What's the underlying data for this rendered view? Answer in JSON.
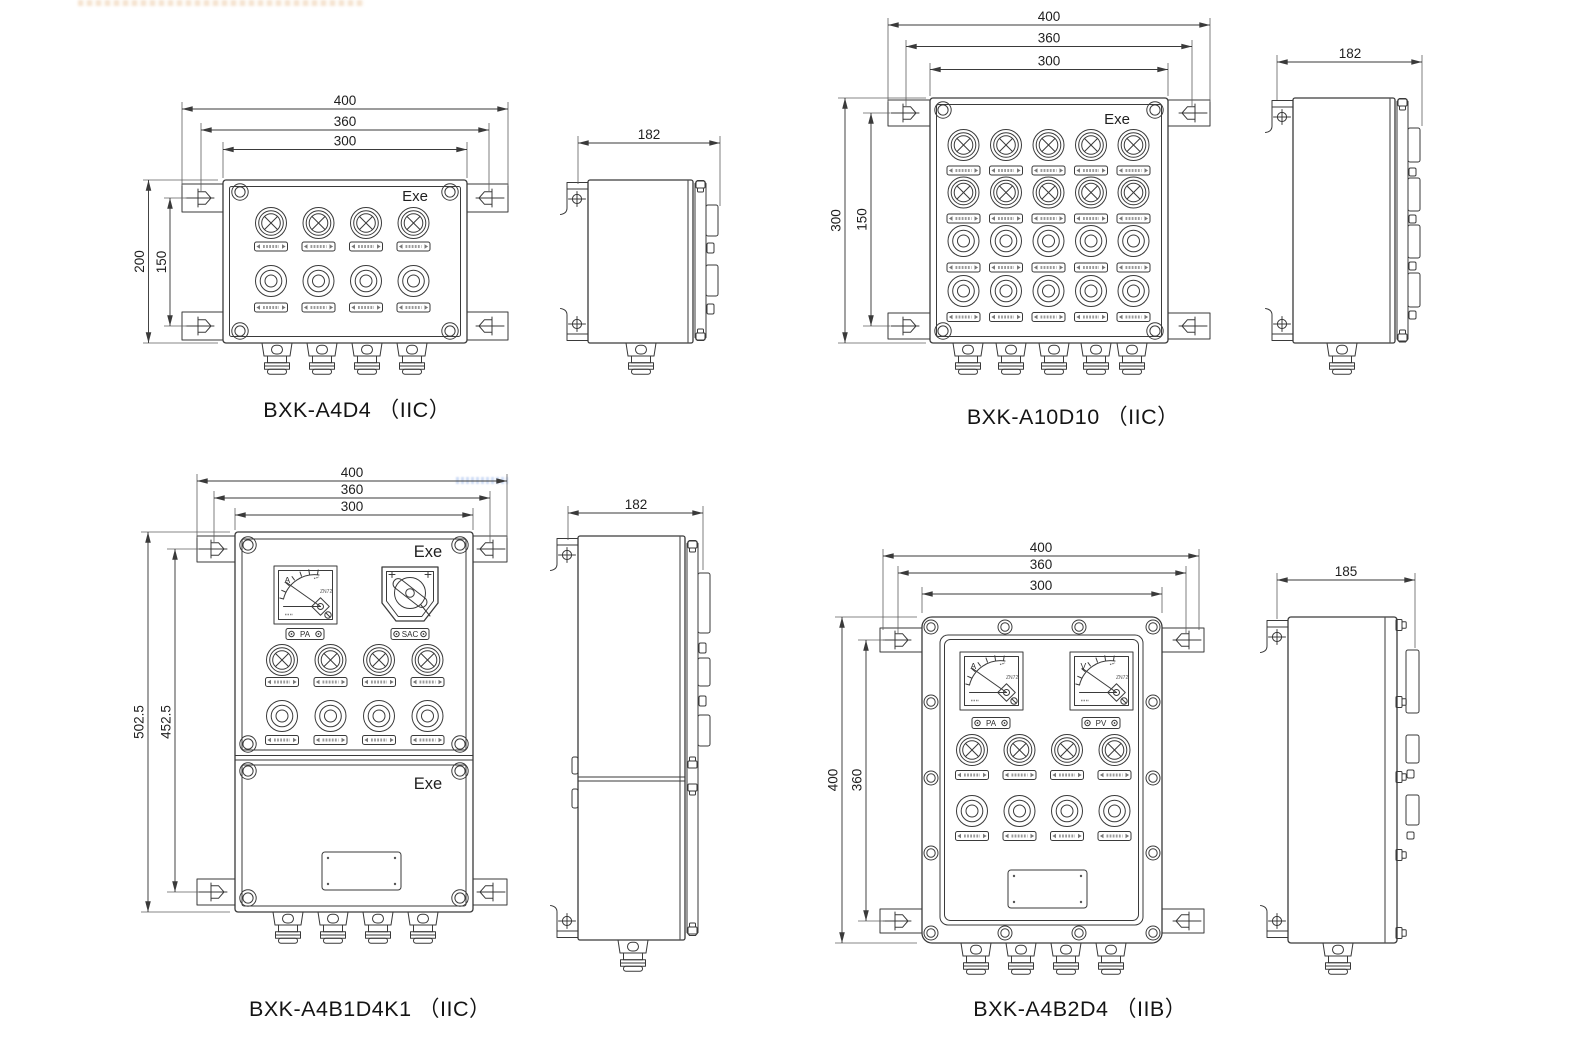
{
  "sheet": {
    "type": "product-outline-and-installation-dimension-drawing",
    "units_implied": "mm",
    "line_color": "#3a3a3a",
    "background": "#ffffff"
  },
  "models": [
    {
      "name": "BXK-A4D4",
      "caption": "BXK-A4D4 （IIC）",
      "marking": "Exe",
      "layout": {
        "lamp_rows": 1,
        "lamp_cols": 4,
        "button_rows": 1,
        "button_cols": 4,
        "cable_glands": 4
      },
      "dims": {
        "top": [
          "400",
          "360",
          "300"
        ],
        "left": [
          "200",
          "150"
        ],
        "side_width": "182"
      }
    },
    {
      "name": "BXK-A10D10",
      "caption": "BXK-A10D10 （IIC）",
      "marking": "Exe",
      "layout": {
        "lamp_rows": 2,
        "lamp_cols": 5,
        "button_rows": 2,
        "button_cols": 5,
        "cable_glands": 5
      },
      "dims": {
        "top": [
          "400",
          "360",
          "300"
        ],
        "left": [
          "300",
          "150"
        ],
        "side_width": "182"
      }
    },
    {
      "name": "BXK-A4B1D4K1",
      "caption": "BXK-A4B1D4K1 （IIC）",
      "marking_upper": "Exe",
      "marking_lower": "Exe",
      "layout": {
        "lamp_rows": 1,
        "lamp_cols": 4,
        "button_rows": 1,
        "button_cols": 4,
        "cable_glands": 4,
        "doors": 2
      },
      "instruments": {
        "ammeter": {
          "unit": "A",
          "model": "ZN72",
          "tag": "PA"
        },
        "selector_switch": {
          "tag": "SAC"
        }
      },
      "dims": {
        "top": [
          "400",
          "360",
          "300"
        ],
        "left": [
          "502.5",
          "452.5"
        ],
        "side_width": "182"
      }
    },
    {
      "name": "BXK-A4B2D4",
      "caption": "BXK-A4B2D4 （IIB）",
      "layout": {
        "lamp_rows": 1,
        "lamp_cols": 4,
        "button_rows": 1,
        "button_cols": 4,
        "cable_glands": 4,
        "flange_bolts": 14
      },
      "instruments": {
        "ammeter": {
          "unit": "A",
          "model": "ZN72",
          "tag": "PA"
        },
        "voltmeter": {
          "unit": "V",
          "model": "ZN72",
          "tag": "PV"
        }
      },
      "dims": {
        "top": [
          "400",
          "360",
          "300"
        ],
        "left": [
          "400",
          "360"
        ],
        "side_width": "185"
      }
    }
  ]
}
